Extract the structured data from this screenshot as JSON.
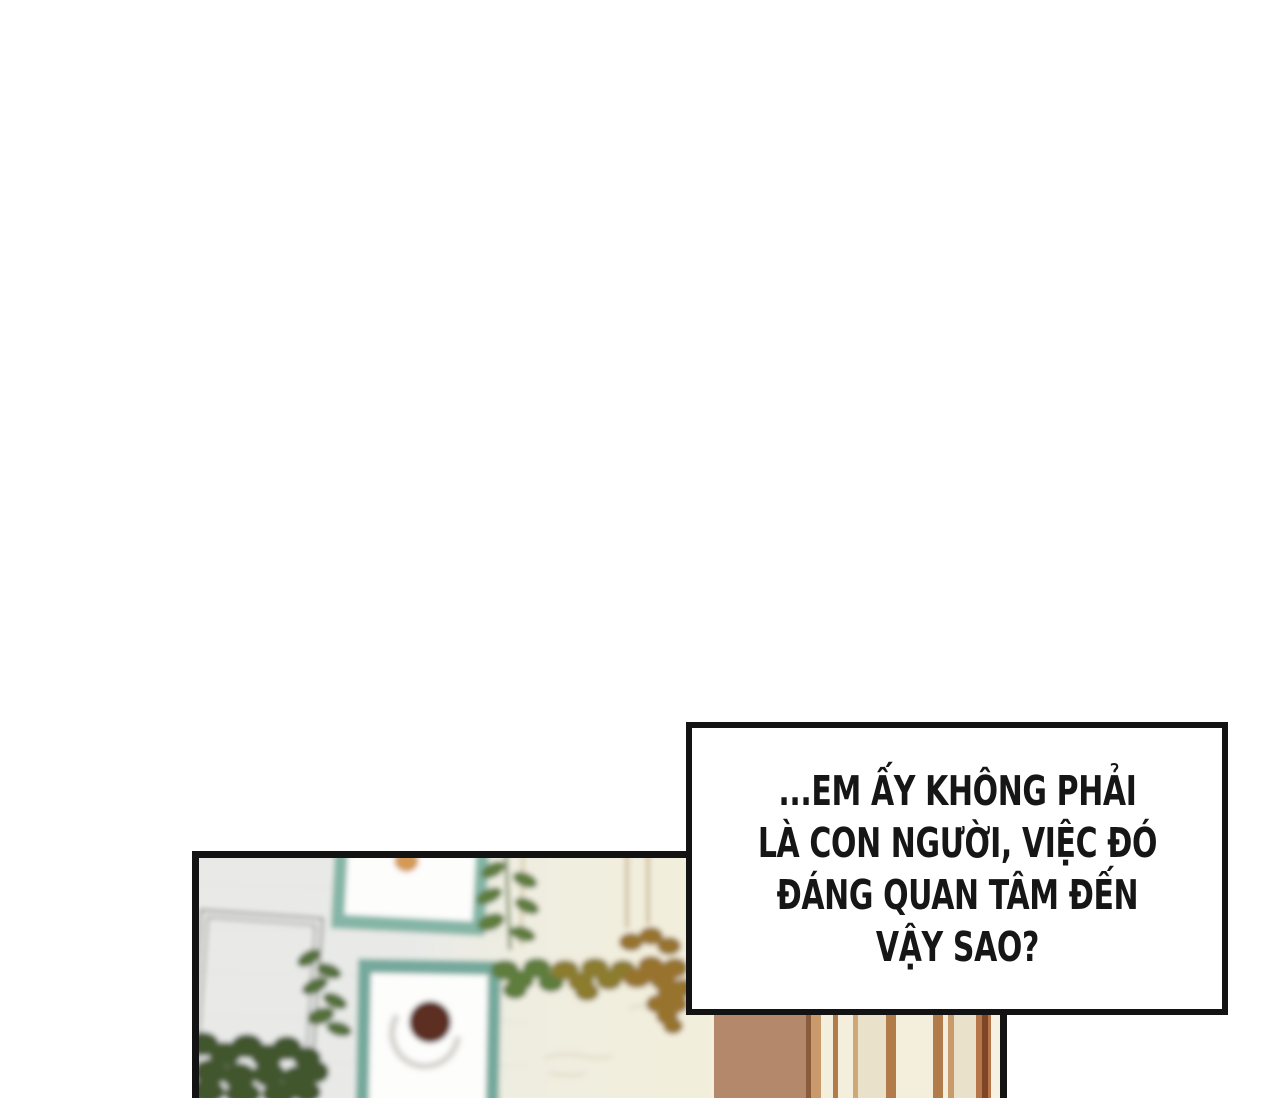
{
  "page": {
    "background": "#ffffff"
  },
  "speech_bubble": {
    "lines": [
      "...EM ẤY KHÔNG PHẢI",
      "LÀ CON NGƯỜI, VIỆC ĐÓ",
      "ĐÁNG QUAN TÂM ĐẾN",
      "VẬY SAO?"
    ],
    "background": "#ffffff",
    "border_color": "#131313",
    "text_color": "#161616"
  },
  "artwork_panel": {
    "border_color": "#131313",
    "colors": {
      "wall_left": "#e9eae8",
      "wall_mid": "#efede0",
      "wall_right": "#f3eedb",
      "frame_teal": "#84b5a6",
      "frame_teal_dark": "#74a99c",
      "picture_white": "#fdfdfc",
      "orange_fruit": "#d49a55",
      "coffee_brown": "#5d2d23",
      "saucer_gray": "#d7d6d0",
      "wire_gray": "#8e8e8a",
      "leaf_green": "#5f7d3c",
      "leaf_mid_green": "#55703a",
      "leaf_dark_green": "#42572f",
      "leaf_olive": "#8b7c2e",
      "leaf_tan": "#97732d",
      "string_tan": "#b9a06a",
      "wood_brown": "#b3886b",
      "wood_brown_dark": "#8a5c3c",
      "wood_tan": "#c99a6c",
      "wood_line": "#b27c4a",
      "wood_line_light": "#cfa878",
      "wood_rust": "#b5764a",
      "wood_rust_dark": "#7e4526",
      "wood_cream": "#f4eedd",
      "wood_beige": "#eae1cb",
      "wood_pale": "#f6f1e0"
    }
  }
}
